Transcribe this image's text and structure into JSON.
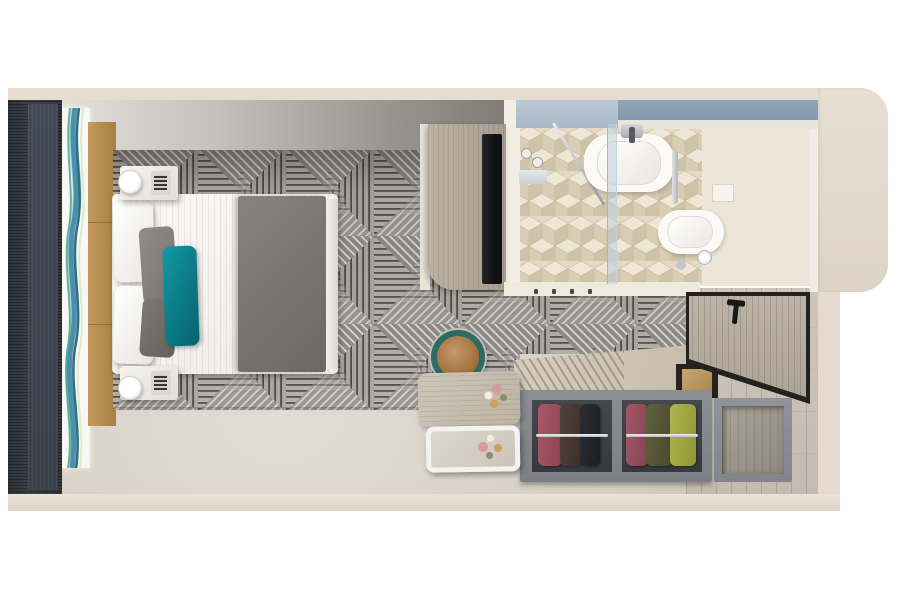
{
  "meta": {
    "title": "Cruise stateroom 3D floor plan",
    "view": "top-down architectural render",
    "width_px": 903,
    "height_px": 602,
    "visible_text": "none"
  },
  "regions": {
    "stage": {
      "label": "Stateroom floor plan render"
    },
    "bedroom": {
      "label": "Bedroom area with queen bed on geometric carpet"
    },
    "bathroom": {
      "label": "Bathroom with vanity sink, glass shower and toilet on beige cube tile"
    },
    "closet": {
      "label": "Open wardrobe with hanging clothes, safe and luggage bench"
    },
    "entry": {
      "label": "Entry hall with open wood door on plank flooring"
    },
    "balcony_wall": {
      "label": "Dark partition wall and floor-to-ceiling wave artwork window"
    }
  },
  "furniture": [
    {
      "name": "queen-bed",
      "description": "White linens with charcoal runner duvet at foot",
      "colors": [
        "#f5f4f1",
        "#7b7875"
      ]
    },
    {
      "name": "accent-pillow",
      "description": "Teal velvet accent pillows",
      "color": "#0c7f8b"
    },
    {
      "name": "gray-pillows",
      "description": "Two gray pillows",
      "color": "#85827e"
    },
    {
      "name": "headboard",
      "description": "Camel upholstered headboard wall panel",
      "color": "#b28b50"
    },
    {
      "name": "nightstands",
      "description": "Two white marble nightstands with cylinder lamps",
      "color": "#f2f0ec"
    },
    {
      "name": "wave-artwork",
      "description": "Blue-teal agate wave art strip beside bed",
      "colors": [
        "#4b8fa8",
        "#2e6f86",
        "#9fc9d4",
        "#3aa08f"
      ]
    },
    {
      "name": "vanity-desk-tv",
      "description": "Wood vanity console with wall-mounted TV",
      "colors": [
        "#b1a799",
        "#17181a"
      ]
    },
    {
      "name": "stool",
      "description": "Round stool, teal rim with tan leather seat",
      "colors": [
        "#2e6b64",
        "#b5885a"
      ]
    },
    {
      "name": "writing-desk",
      "description": "Light wood desk with flowers and white pull-out tray",
      "colors": [
        "#c6bdaf",
        "#f4f3f1"
      ]
    },
    {
      "name": "wardrobe",
      "description": "Open double wardrobe with burgundy, brown, black, olive and chartreuse garments on chrome rails",
      "colors": [
        "#9a5260",
        "#453931",
        "#26272c",
        "#565934",
        "#9aa23e"
      ]
    },
    {
      "name": "safe",
      "description": "In-closet safe nook with tan case",
      "color": "#bf9c66"
    },
    {
      "name": "side-cabinet",
      "description": "Open gray shelf cabinet near door",
      "color": "#8d9196"
    },
    {
      "name": "entry-door",
      "description": "Open cabin door, wood leaf with black frame and lever handle",
      "colors": [
        "#b5ac9f",
        "#23221f"
      ]
    },
    {
      "name": "sink",
      "description": "White rectangular vessel sink with chrome faucet",
      "color": "#fbfaf7"
    },
    {
      "name": "toilet",
      "description": "White toilet with flush plate and paper holder",
      "color": "#fbfaf7"
    },
    {
      "name": "shower",
      "description": "Glass-partitioned shower over beige cube mosaic tile",
      "colors": [
        "#bed0dc",
        "#e3d9c5"
      ]
    },
    {
      "name": "bath-shelf",
      "description": "Slate blue towel shelf band across bathroom top",
      "colors": [
        "#b5c2d0",
        "#8d9fb2"
      ]
    }
  ],
  "materials": {
    "carpet": {
      "description": "Gray triangle-weave geometric carpet",
      "base": "#aeaba6",
      "line_dark": "#55524e",
      "line_light": "#dddad5"
    },
    "bedroom_floor": "#d5cfc5",
    "entry_floor": "#c9c2b8",
    "bath_tile": "#e3d9c5",
    "outer_wall": "#e6ddd0",
    "dark_wall": "#3c4149"
  }
}
